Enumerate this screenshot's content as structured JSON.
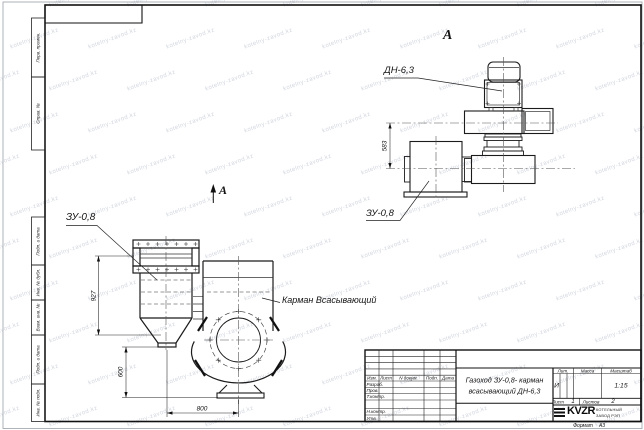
{
  "watermark": {
    "text": "kotelny-zavod.kz"
  },
  "margin_labels": [
    "Перв. примен.",
    "Справ. №",
    "Подп. и дата",
    "Инв. № дубл.",
    "Взам. инв. №",
    "Подп. и дата",
    "Инв. № подл."
  ],
  "drawing": {
    "view_marker": "А",
    "view_title": "А",
    "label_zu_front": "ЗУ-0,8",
    "label_pocket": "Карман Всасывающий",
    "label_dn": "ДН-6,3",
    "label_zu_side": "ЗУ-0,8",
    "dim_927": "927",
    "dim_600": "600",
    "dim_800": "800",
    "dim_583": "583"
  },
  "title_block": {
    "cols": {
      "izm": "Изм.",
      "list": "Лист",
      "ndoc": "N докум.",
      "podp": "Подп.",
      "data": "Дата"
    },
    "rows": {
      "razrab": "Разраб.",
      "prov": "Пров.",
      "tkontr": "Т.контр.",
      "nkontr": "Н.контр.",
      "utv": "Утв."
    },
    "title_line1": "Газоход ЗУ-0,8-  карман",
    "title_line2": "всасывающий ДН-6,3",
    "lit_header": "Лит.",
    "lit_value": "И",
    "massa_header": "Масса",
    "scale_header": "Масштаб",
    "scale_value": "1:15",
    "sheet_label": "Лист",
    "sheet_value": "1",
    "sheets_label": "Листов",
    "sheets_value": "2",
    "logo_name": "KVZR",
    "logo_sub1": "КОТЕЛЬНЫЙ",
    "logo_sub2": "ЗАВОД РЭП",
    "format_label": "Формат",
    "format_value": "А3"
  }
}
